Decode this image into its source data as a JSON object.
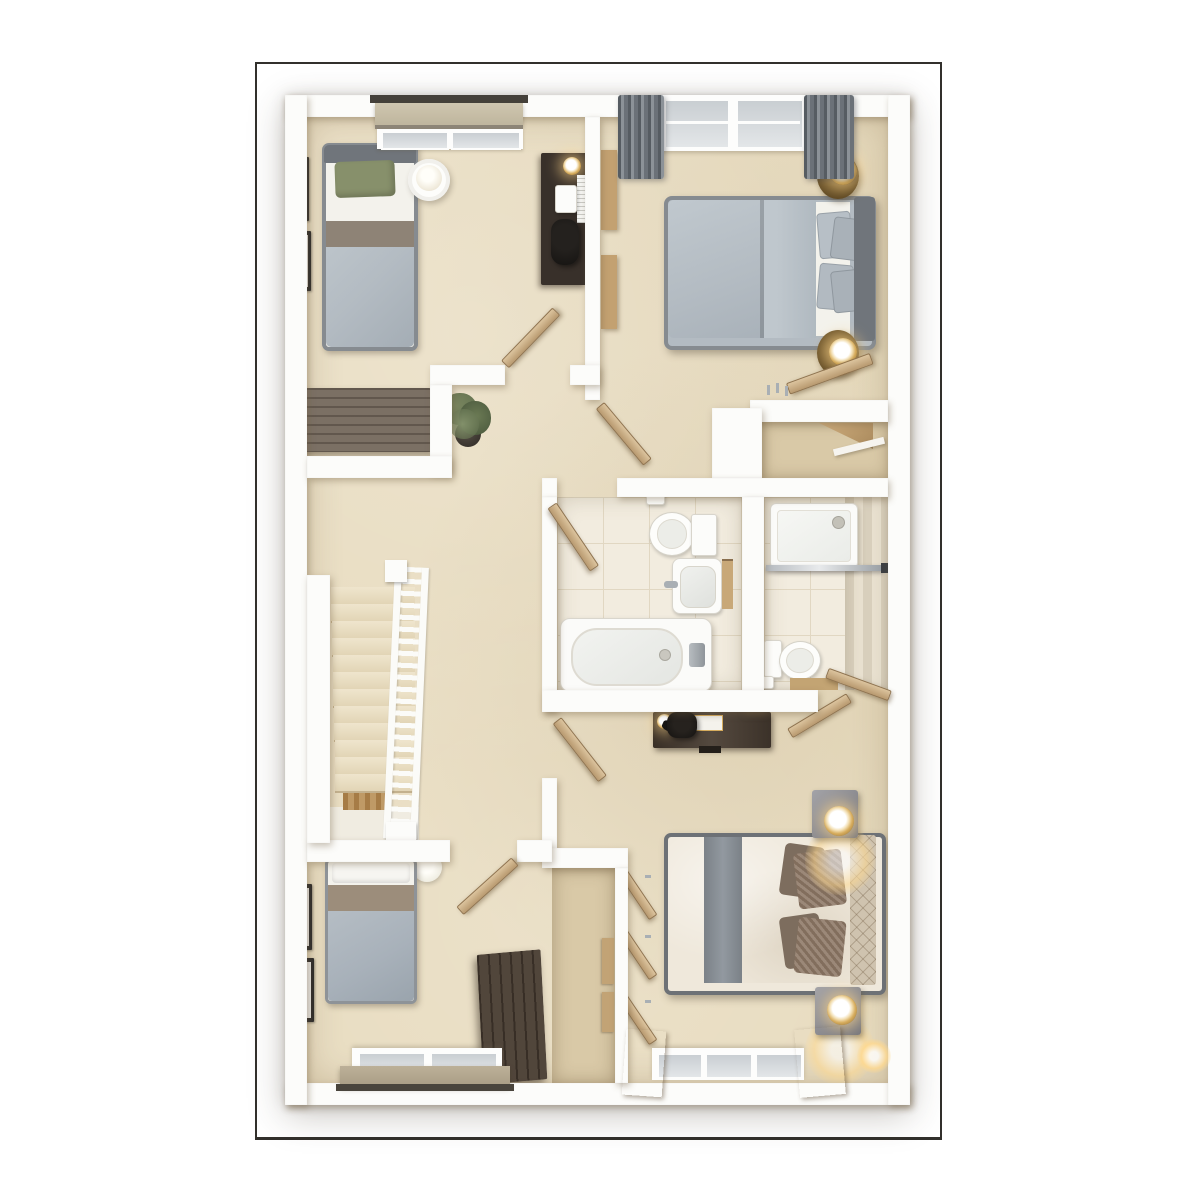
{
  "meta": {
    "type": "3d-floor-plan-render",
    "view": "top-down dollhouse view, no text labels visible",
    "description": "Upper floor plan with four bedrooms, family bathroom, en-suite shower room, built-in cupboard and a central landing with staircase"
  },
  "palette": {
    "wall": "#fcfcfa",
    "frame": "#32302c",
    "carpet": "#e8dcc0",
    "carpetDark": "#d9c9a7",
    "tile": "#f2ecdf",
    "grout": "#e1d7c2",
    "tileStripA": "#d8cfbc",
    "tileStripB": "#e8e0cf",
    "woodDoor": "#c9ab7f",
    "woodDark": "#8a6f4e",
    "stairWood": "#bf9a66",
    "furnDark": "#38302a",
    "sideboard": "#74685c",
    "wardrobeDark": "#4a3e33",
    "duvetGray": "#b3bbc2",
    "duvetCream": "#efe8db",
    "sheetWhite": "#f3f2ec",
    "pillowGreen": "#87906b",
    "taupeBand": "#8e8376",
    "bedFrame": "#868b90",
    "headboardDark": "#70757b",
    "headboardTan": "#cfc3af",
    "pillowBrown": "#8d7765",
    "curtainGray": "#70767d",
    "glass": "#ccd1d5",
    "gold": "#d7ad5e",
    "glow": "#ffd98f",
    "chrome": "#a9afb4",
    "plantGreen": "#5f6e4d",
    "potDark": "#2c2823"
  },
  "rooms": [
    {
      "id": "bedroom-top-left",
      "label": "Single bedroom (top left): single bed with green pillow, desk with chair, round side table, sideboard, two wall pictures, window with roller blind"
    },
    {
      "id": "master-bedroom",
      "label": "Double bedroom (top right): double bed, two round bedside tables with lamps, two windows with grey curtains, wardrobe and dressing nook"
    },
    {
      "id": "bathroom",
      "label": "Family bathroom: bathtub, toilet, washbasin, towel ladder"
    },
    {
      "id": "en-suite",
      "label": "En-suite shower room: shower tray with glass screen, toilet, wooden mat"
    },
    {
      "id": "landing",
      "label": "Landing with carpeted staircase, white balustrade and potted plant"
    },
    {
      "id": "bedroom-bottom-left",
      "label": "Single bedroom (bottom left): single bed, dark wardrobe, two wall pictures, window with roller blind"
    },
    {
      "id": "bedroom-bottom-right",
      "label": "Double bedroom (bottom right): double bed with brown cushions, two bedside tables with lamps, desk, open wardrobe, window with slatted curtains"
    },
    {
      "id": "cupboard",
      "label": "Built-in cupboard"
    }
  ],
  "stairs": {
    "step_count": 12,
    "step_height": 17
  }
}
